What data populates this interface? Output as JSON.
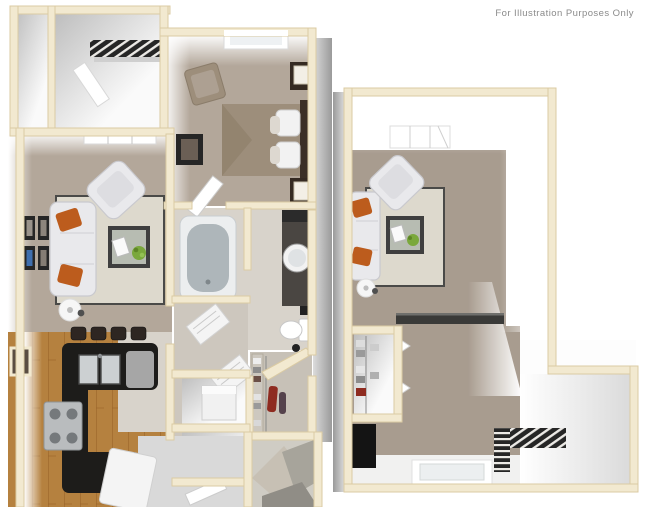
{
  "page": {
    "background": "#ffffff",
    "annotation": "For Illustration Purposes Only"
  },
  "colors": {
    "page_bg": "#ffffff",
    "annotation_text": "#8a8a8a",
    "wall": "#f2e9d0",
    "wall_edge": "#dbcba3",
    "carpet": "#b3a79a",
    "carpet_right": "#a89c8f",
    "tile": "#d8d3cb",
    "hall_tile": "#cdc7be",
    "wood": "#b5813f",
    "wood_grain": "#976228",
    "counter": "#1d1c1a",
    "stool": "#2e2622",
    "sofa": "#e9e9ec",
    "sofa_shadow": "#c9c9ce",
    "pillow_orange": "#bc5c1d",
    "rug": "#ddd9cd",
    "rug_border": "#4a4a48",
    "table_frame": "#3f3f3f",
    "glass": "#b7bcb2",
    "plant": "#7aa83c",
    "bed": "#9d8e7b",
    "headboard": "#3b2f26",
    "wood_dark_furniture": "#352a22",
    "white_linen": "#f4f4f4",
    "tub_inner": "#aeb6ba",
    "vanity": "#4a4642",
    "grate": "#262626",
    "entry_floor": "#d9d9d9",
    "closet_floor": "#c7c1b7",
    "red_garment": "#8e2b20",
    "frame_blue": "#3f6fae",
    "frame_dark": "#262626"
  },
  "floorplan": {
    "style": "3d-top-down-render",
    "left_unit": {
      "rooms": [
        "closet",
        "stair-landing",
        "bedroom",
        "living-room",
        "kitchen",
        "bathroom",
        "hallway",
        "walk-in-closet",
        "laundry-closet",
        "entry"
      ],
      "furniture": [
        "staircase-grate",
        "open-door",
        "bed",
        "pillows",
        "headboard",
        "nightstand-with-lamp",
        "corner-chair",
        "wall-picture",
        "window",
        "sofa",
        "orange-throw-pillows",
        "armchair",
        "coffee-table",
        "book",
        "plant",
        "area-rug",
        "gallery-frames",
        "floor-lamp",
        "bar-stools",
        "l-shaped-counter",
        "double-sink",
        "dishwasher",
        "stove",
        "refrigerator",
        "bathtub",
        "vanity-with-round-sink",
        "toilet",
        "linen-shelves",
        "washer",
        "closet-shelving",
        "red-garment",
        "stair-underside"
      ]
    },
    "right_unit": {
      "rooms": [
        "living-room",
        "closet",
        "stair-landing",
        "entry"
      ],
      "furniture": [
        "ceiling-vent",
        "sofa",
        "orange-throw-pillows",
        "armchair",
        "coffee-table",
        "book",
        "plant",
        "area-rug",
        "floor-lamp",
        "breakfast-bar",
        "closet-shelves",
        "bifold-doors",
        "dark-cabinet",
        "staircase-grate",
        "window"
      ]
    }
  }
}
